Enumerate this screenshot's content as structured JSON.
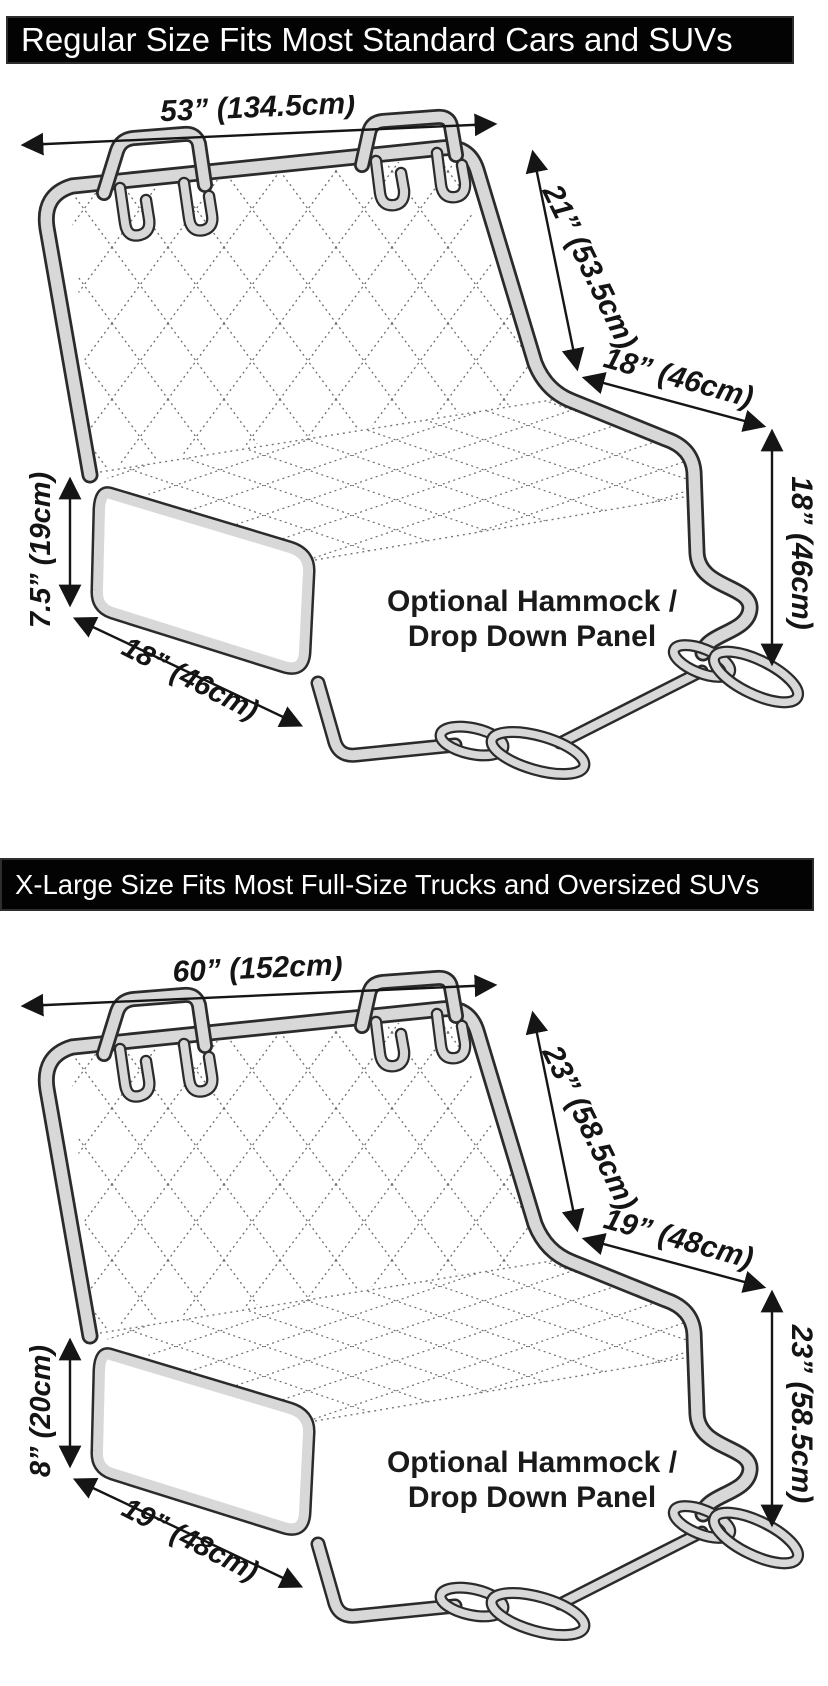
{
  "page": {
    "background": "#ffffff"
  },
  "colors": {
    "header_bg": "#030303",
    "header_text": "#ffffff",
    "cover_band_fill": "#d8d8d8",
    "cover_band_outline": "#2b2b2b",
    "quilt_stitch": "#6e6e6e",
    "dimension_text": "#141414"
  },
  "sections": [
    {
      "header": "Regular Size Fits Most Standard Cars and SUVs",
      "labels": {
        "top_width": "53” (134.5cm)",
        "back_height": "21” (53.5cm)",
        "seat_depth": "18” (46cm)",
        "drop_height": "18” (46cm)",
        "flap_height": "7.5” (19cm)",
        "flap_width": "18” (46cm)",
        "hammock_line1": "Optional Hammock /",
        "hammock_line2": "Drop Down Panel"
      }
    },
    {
      "header": "X-Large Size Fits Most Full-Size Trucks and Oversized SUVs",
      "labels": {
        "top_width": "60” (152cm)",
        "back_height": "23” (58.5cm)",
        "seat_depth": "19” (48cm)",
        "drop_height": "23” (58.5cm)",
        "flap_height": "8” (20cm)",
        "flap_width": "19” (48cm)",
        "hammock_line1": "Optional Hammock /",
        "hammock_line2": "Drop Down Panel"
      }
    }
  ]
}
